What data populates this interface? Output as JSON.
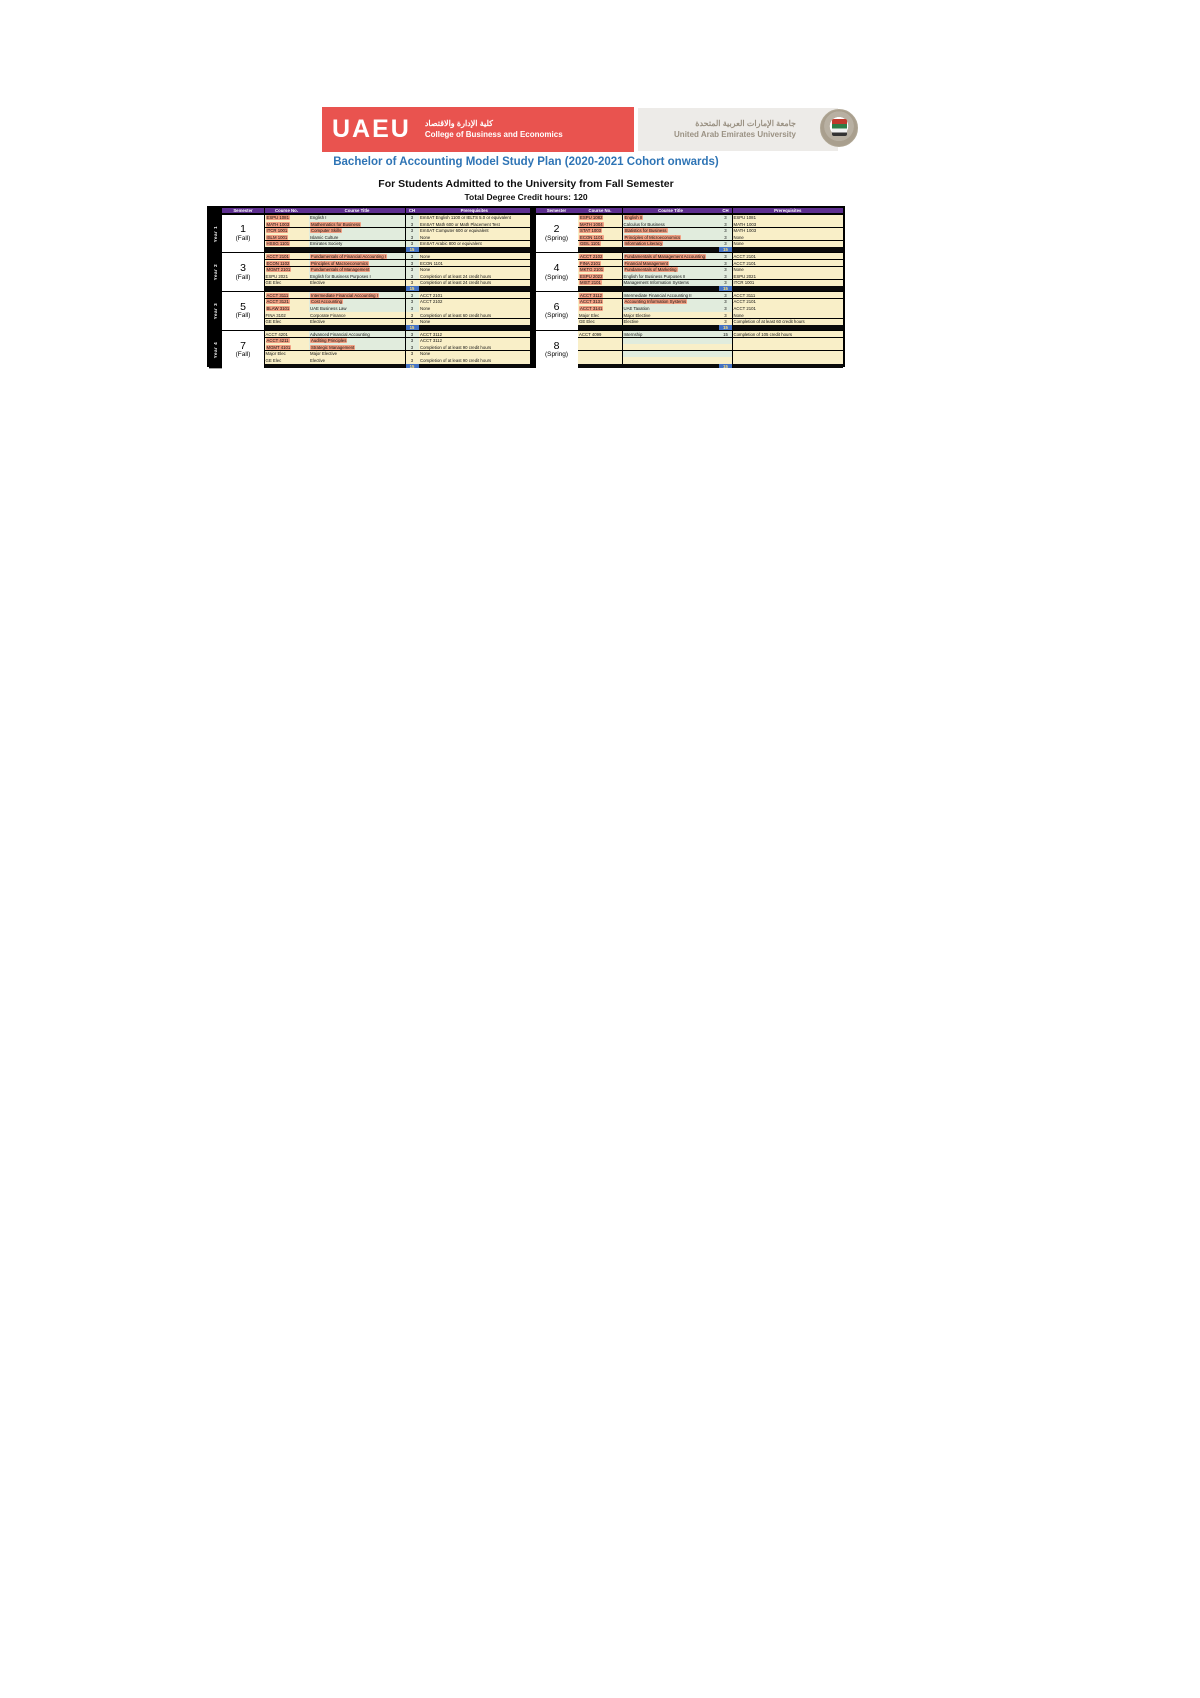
{
  "header": {
    "college": {
      "wordmark": "UAEU",
      "arabic": "كلية الإدارة والاقتصاد",
      "english": "College of Business and Economics"
    },
    "university": {
      "arabic": "جامعة الإمارات العربية المتحدة",
      "english": "United Arab Emirates University",
      "emblem": "uaeu-falcon-crest"
    }
  },
  "titles": {
    "main": "Bachelor of Accounting Model Study Plan (2020-2021 Cohort onwards)",
    "subtitle": "For Students Admitted to the University from Fall Semester",
    "credits": "Total Degree Credit hours: 120"
  },
  "colors": {
    "header_purple": "#5d2e8f",
    "logo_red": "#e9534f",
    "logo_gray": "#edebe8",
    "title_blue": "#2e74b5",
    "row_green": "#e1ecdd",
    "row_cream": "#f9efc8",
    "highlight_orange": "#f2a083",
    "total_blue": "#4472c4"
  },
  "table": {
    "columns": [
      "Semester",
      "Course No.",
      "Course Title",
      "CH",
      "Prerequisites"
    ],
    "years": [
      {
        "label": "Year 1",
        "semesters": [
          {
            "num": "1",
            "term": "(Fall)",
            "total": "15",
            "courses": [
              {
                "no": "ESPU 1081",
                "title": "English I",
                "ch": "3",
                "pre": "EmSAT English 1100 or IELTS 5.0 or equivalent",
                "hn": true,
                "ht": false
              },
              {
                "no": "MATH 1003",
                "title": "Mathematics for Business",
                "ch": "3",
                "pre": "EmSAT Math 600 or Math Placement Test",
                "hn": true,
                "ht": true
              },
              {
                "no": "ITCR 1001",
                "title": "Computer Skills",
                "ch": "3",
                "pre": "EmSAT Computer 600 or equivalent",
                "hn": true,
                "ht": true
              },
              {
                "no": "ISLM 1001",
                "title": "Islamic Culture",
                "ch": "3",
                "pre": "None",
                "hn": true,
                "ht": false
              },
              {
                "no": "HSSG 1101",
                "title": "Emirates Society",
                "ch": "3",
                "pre": "EmSAT Arabic 800 or equivalent",
                "hn": true,
                "ht": false
              }
            ]
          },
          {
            "num": "2",
            "term": "(Spring)",
            "total": "15",
            "courses": [
              {
                "no": "ESPU 1082",
                "title": "English II",
                "ch": "3",
                "pre": "ESPU 1081",
                "hn": true,
                "ht": true
              },
              {
                "no": "MATH 1004",
                "title": "Calculus for Business",
                "ch": "3",
                "pre": "MATH 1003",
                "hn": true,
                "ht": false
              },
              {
                "no": "STAT 1003",
                "title": "Statistics for Business",
                "ch": "3",
                "pre": "MATH 1003",
                "hn": true,
                "ht": true
              },
              {
                "no": "ECON 1101",
                "title": "Principles of Microeconomics",
                "ch": "3",
                "pre": "None",
                "hn": true,
                "ht": true
              },
              {
                "no": "GEIL 1101",
                "title": "Information Literacy",
                "ch": "3",
                "pre": "None",
                "hn": true,
                "ht": true
              }
            ]
          }
        ]
      },
      {
        "label": "Year 2",
        "semesters": [
          {
            "num": "3",
            "term": "(Fall)",
            "total": "15",
            "courses": [
              {
                "no": "ACCT 2101",
                "title": "Fundamentals of Financial Accounting I",
                "ch": "3",
                "pre": "None",
                "hn": true,
                "ht": true
              },
              {
                "no": "ECON 1102",
                "title": "Principles of Macroeconomics",
                "ch": "3",
                "pre": "ECON 1101",
                "hn": true,
                "ht": true
              },
              {
                "no": "MGMT 2101",
                "title": "Fundamentals of Management",
                "ch": "3",
                "pre": "None",
                "hn": true,
                "ht": true
              },
              {
                "no": "ESPU 2021",
                "title": "English for Business Purposes I",
                "ch": "3",
                "pre": "Completion of at least 24 credit hours",
                "hn": false,
                "ht": false
              },
              {
                "no": "GE Elec",
                "title": "Elective",
                "ch": "3",
                "pre": "Completion of at least 24 credit hours",
                "hn": false,
                "ht": false,
                "tone": "cream"
              }
            ]
          },
          {
            "num": "4",
            "term": "(Spring)",
            "total": "15",
            "courses": [
              {
                "no": "ACCT 2102",
                "title": "Fundamentals of Management Accounting",
                "ch": "3",
                "pre": "ACCT 2101",
                "hn": true,
                "ht": true
              },
              {
                "no": "FINA 2101",
                "title": "Financial Management",
                "ch": "3",
                "pre": "ACCT 2101",
                "hn": true,
                "ht": true
              },
              {
                "no": "MKTG 2101",
                "title": "Fundamentals of Marketing",
                "ch": "3",
                "pre": "None",
                "hn": true,
                "ht": true
              },
              {
                "no": "ESPU 2022",
                "title": "English for Business Purposes II",
                "ch": "3",
                "pre": "ESPU 2021",
                "hn": true,
                "ht": false
              },
              {
                "no": "MIST 2101",
                "title": "Management Information Systems",
                "ch": "3",
                "pre": "ITCR 1001",
                "hn": true,
                "ht": false
              }
            ]
          }
        ]
      },
      {
        "label": "Year 3",
        "semesters": [
          {
            "num": "5",
            "term": "(Fall)",
            "total": "15",
            "courses": [
              {
                "no": "ACCT 3111",
                "title": "Intermediate Financial Accounting I",
                "ch": "3",
                "pre": "ACCT 2101",
                "hn": true,
                "ht": true
              },
              {
                "no": "ACCT 3121",
                "title": "Cost Accounting",
                "ch": "3",
                "pre": "ACCT 2102",
                "hn": true,
                "ht": true
              },
              {
                "no": "BLAW 3101",
                "title": "UAE Business Law",
                "ch": "3",
                "pre": "None",
                "hn": true,
                "ht": false
              },
              {
                "no": "FINA 3102",
                "title": "Corporate Finance",
                "ch": "3",
                "pre": "Completion of at least 60 credit hours",
                "hn": false,
                "ht": false,
                "tone": "cream"
              },
              {
                "no": "GE Elec",
                "title": "Elective",
                "ch": "3",
                "pre": "None",
                "hn": false,
                "ht": false,
                "tone": "cream"
              }
            ]
          },
          {
            "num": "6",
            "term": "(Spring)",
            "total": "15",
            "courses": [
              {
                "no": "ACCT 3112",
                "title": "Intermediate Financial Accounting II",
                "ch": "3",
                "pre": "ACCT 3111",
                "hn": true,
                "ht": false
              },
              {
                "no": "ACCT 3131",
                "title": "Accounting Information Systems",
                "ch": "3",
                "pre": "ACCT 2101",
                "hn": true,
                "ht": true
              },
              {
                "no": "ACCT 3141",
                "title": "UAE Taxation",
                "ch": "3",
                "pre": "ACCT 2101",
                "hn": true,
                "ht": false
              },
              {
                "no": "Major Elec",
                "title": "Major Elective",
                "ch": "3",
                "pre": "None",
                "hn": false,
                "ht": false,
                "tone": "cream"
              },
              {
                "no": "GE Elec",
                "title": "Elective",
                "ch": "3",
                "pre": "Completion of at least 60 credit hours",
                "hn": false,
                "ht": false,
                "tone": "cream"
              }
            ]
          }
        ]
      },
      {
        "label": "Year 4",
        "semesters": [
          {
            "num": "7",
            "term": "(Fall)",
            "total": "15",
            "courses": [
              {
                "no": "ACCT 4201",
                "title": "Advanced Financial Accounting",
                "ch": "3",
                "pre": "ACCT 3112",
                "hn": false,
                "ht": false
              },
              {
                "no": "ACCT 4211",
                "title": "Auditing Principles",
                "ch": "3",
                "pre": "ACCT 3112",
                "hn": true,
                "ht": true
              },
              {
                "no": "MGMT 4101",
                "title": "Strategic Management",
                "ch": "3",
                "pre": "Completion of at least 90 credit hours",
                "hn": true,
                "ht": true
              },
              {
                "no": "Major Elec",
                "title": "Major Elective",
                "ch": "3",
                "pre": "None",
                "hn": false,
                "ht": false,
                "tone": "cream"
              },
              {
                "no": "GE Elec",
                "title": "Elective",
                "ch": "3",
                "pre": "Completion of at least 90 credit hours",
                "hn": false,
                "ht": false,
                "tone": "cream"
              }
            ]
          },
          {
            "num": "8",
            "term": "(Spring)",
            "total": "15",
            "courses": [
              {
                "no": "ACCT 4099",
                "title": "Internship",
                "ch": "15",
                "pre": "Completion of 105 credit hours",
                "hn": false,
                "ht": false
              },
              {
                "no": "",
                "title": "",
                "ch": "",
                "pre": "",
                "hn": false,
                "ht": false
              },
              {
                "no": "",
                "title": "",
                "ch": "",
                "pre": "",
                "hn": false,
                "ht": false,
                "tone": "cream"
              },
              {
                "no": "",
                "title": "",
                "ch": "",
                "pre": "",
                "hn": false,
                "ht": false
              },
              {
                "no": "",
                "title": "",
                "ch": "",
                "pre": "",
                "hn": false,
                "ht": false,
                "tone": "cream"
              }
            ]
          }
        ]
      }
    ]
  }
}
